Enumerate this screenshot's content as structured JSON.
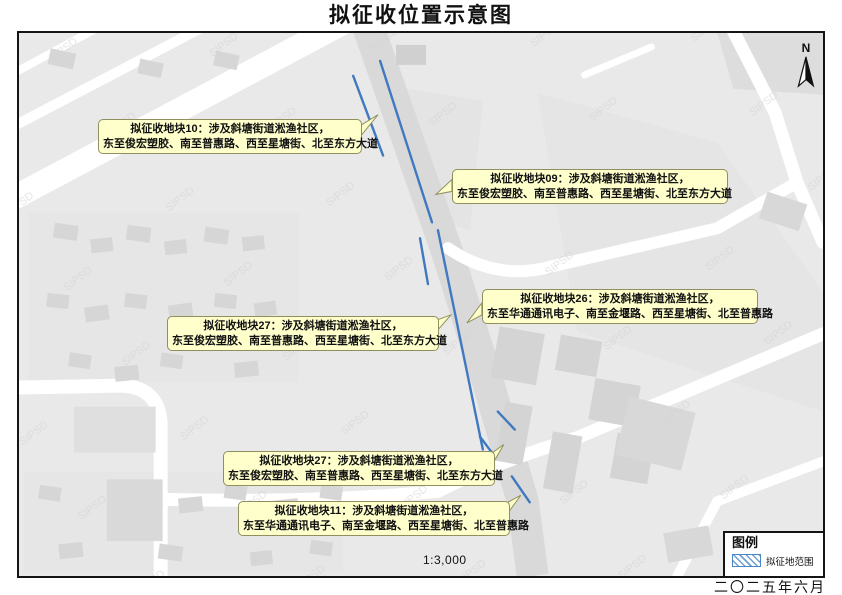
{
  "title": "拟征收位置示意图",
  "map": {
    "scale": "1:3,000",
    "north_label": "N",
    "watermark": "SIPSD",
    "callouts": [
      {
        "id": "parcel-10",
        "line1": "拟征收地块10：涉及斜塘街道淞渔社区，",
        "line2": "东至俊宏塑胶、南至普惠路、西至星塘街、北至东方大道"
      },
      {
        "id": "parcel-09",
        "line1": "拟征收地块09：涉及斜塘街道淞渔社区，",
        "line2": "东至俊宏塑胶、南至普惠路、西至星塘街、北至东方大道"
      },
      {
        "id": "parcel-26",
        "line1": "拟征收地块26：涉及斜塘街道淞渔社区，",
        "line2": "东至华通通讯电子、南至金堰路、西至星塘街、北至普惠路"
      },
      {
        "id": "parcel-27a",
        "line1": "拟征收地块27：涉及斜塘街道淞渔社区，",
        "line2": "东至俊宏塑胶、南至普惠路、西至星塘街、北至东方大道"
      },
      {
        "id": "parcel-27b",
        "line1": "拟征收地块27：涉及斜塘街道淞渔社区，",
        "line2": "东至俊宏塑胶、南至普惠路、西至星塘街、北至东方大道"
      },
      {
        "id": "parcel-11",
        "line1": "拟征收地块11：涉及斜塘街道淞渔社区，",
        "line2": "东至华通通讯电子、南至金堰路、西至星塘街、北至普惠路"
      }
    ],
    "legend": {
      "title": "图例",
      "item_label": "拟征地范围"
    },
    "date": "二〇二五年六月"
  },
  "colors": {
    "boundary_blue": "#4079bf",
    "legend_hatch_blue": "#6ea0d4",
    "callout_bg": "#ffffcc",
    "callout_border": "#90905e",
    "map_bg": "#e9e9e9",
    "road_white": "#ffffff",
    "road_band_gray": "#dadada",
    "building_gray": "#d6d6d6"
  }
}
